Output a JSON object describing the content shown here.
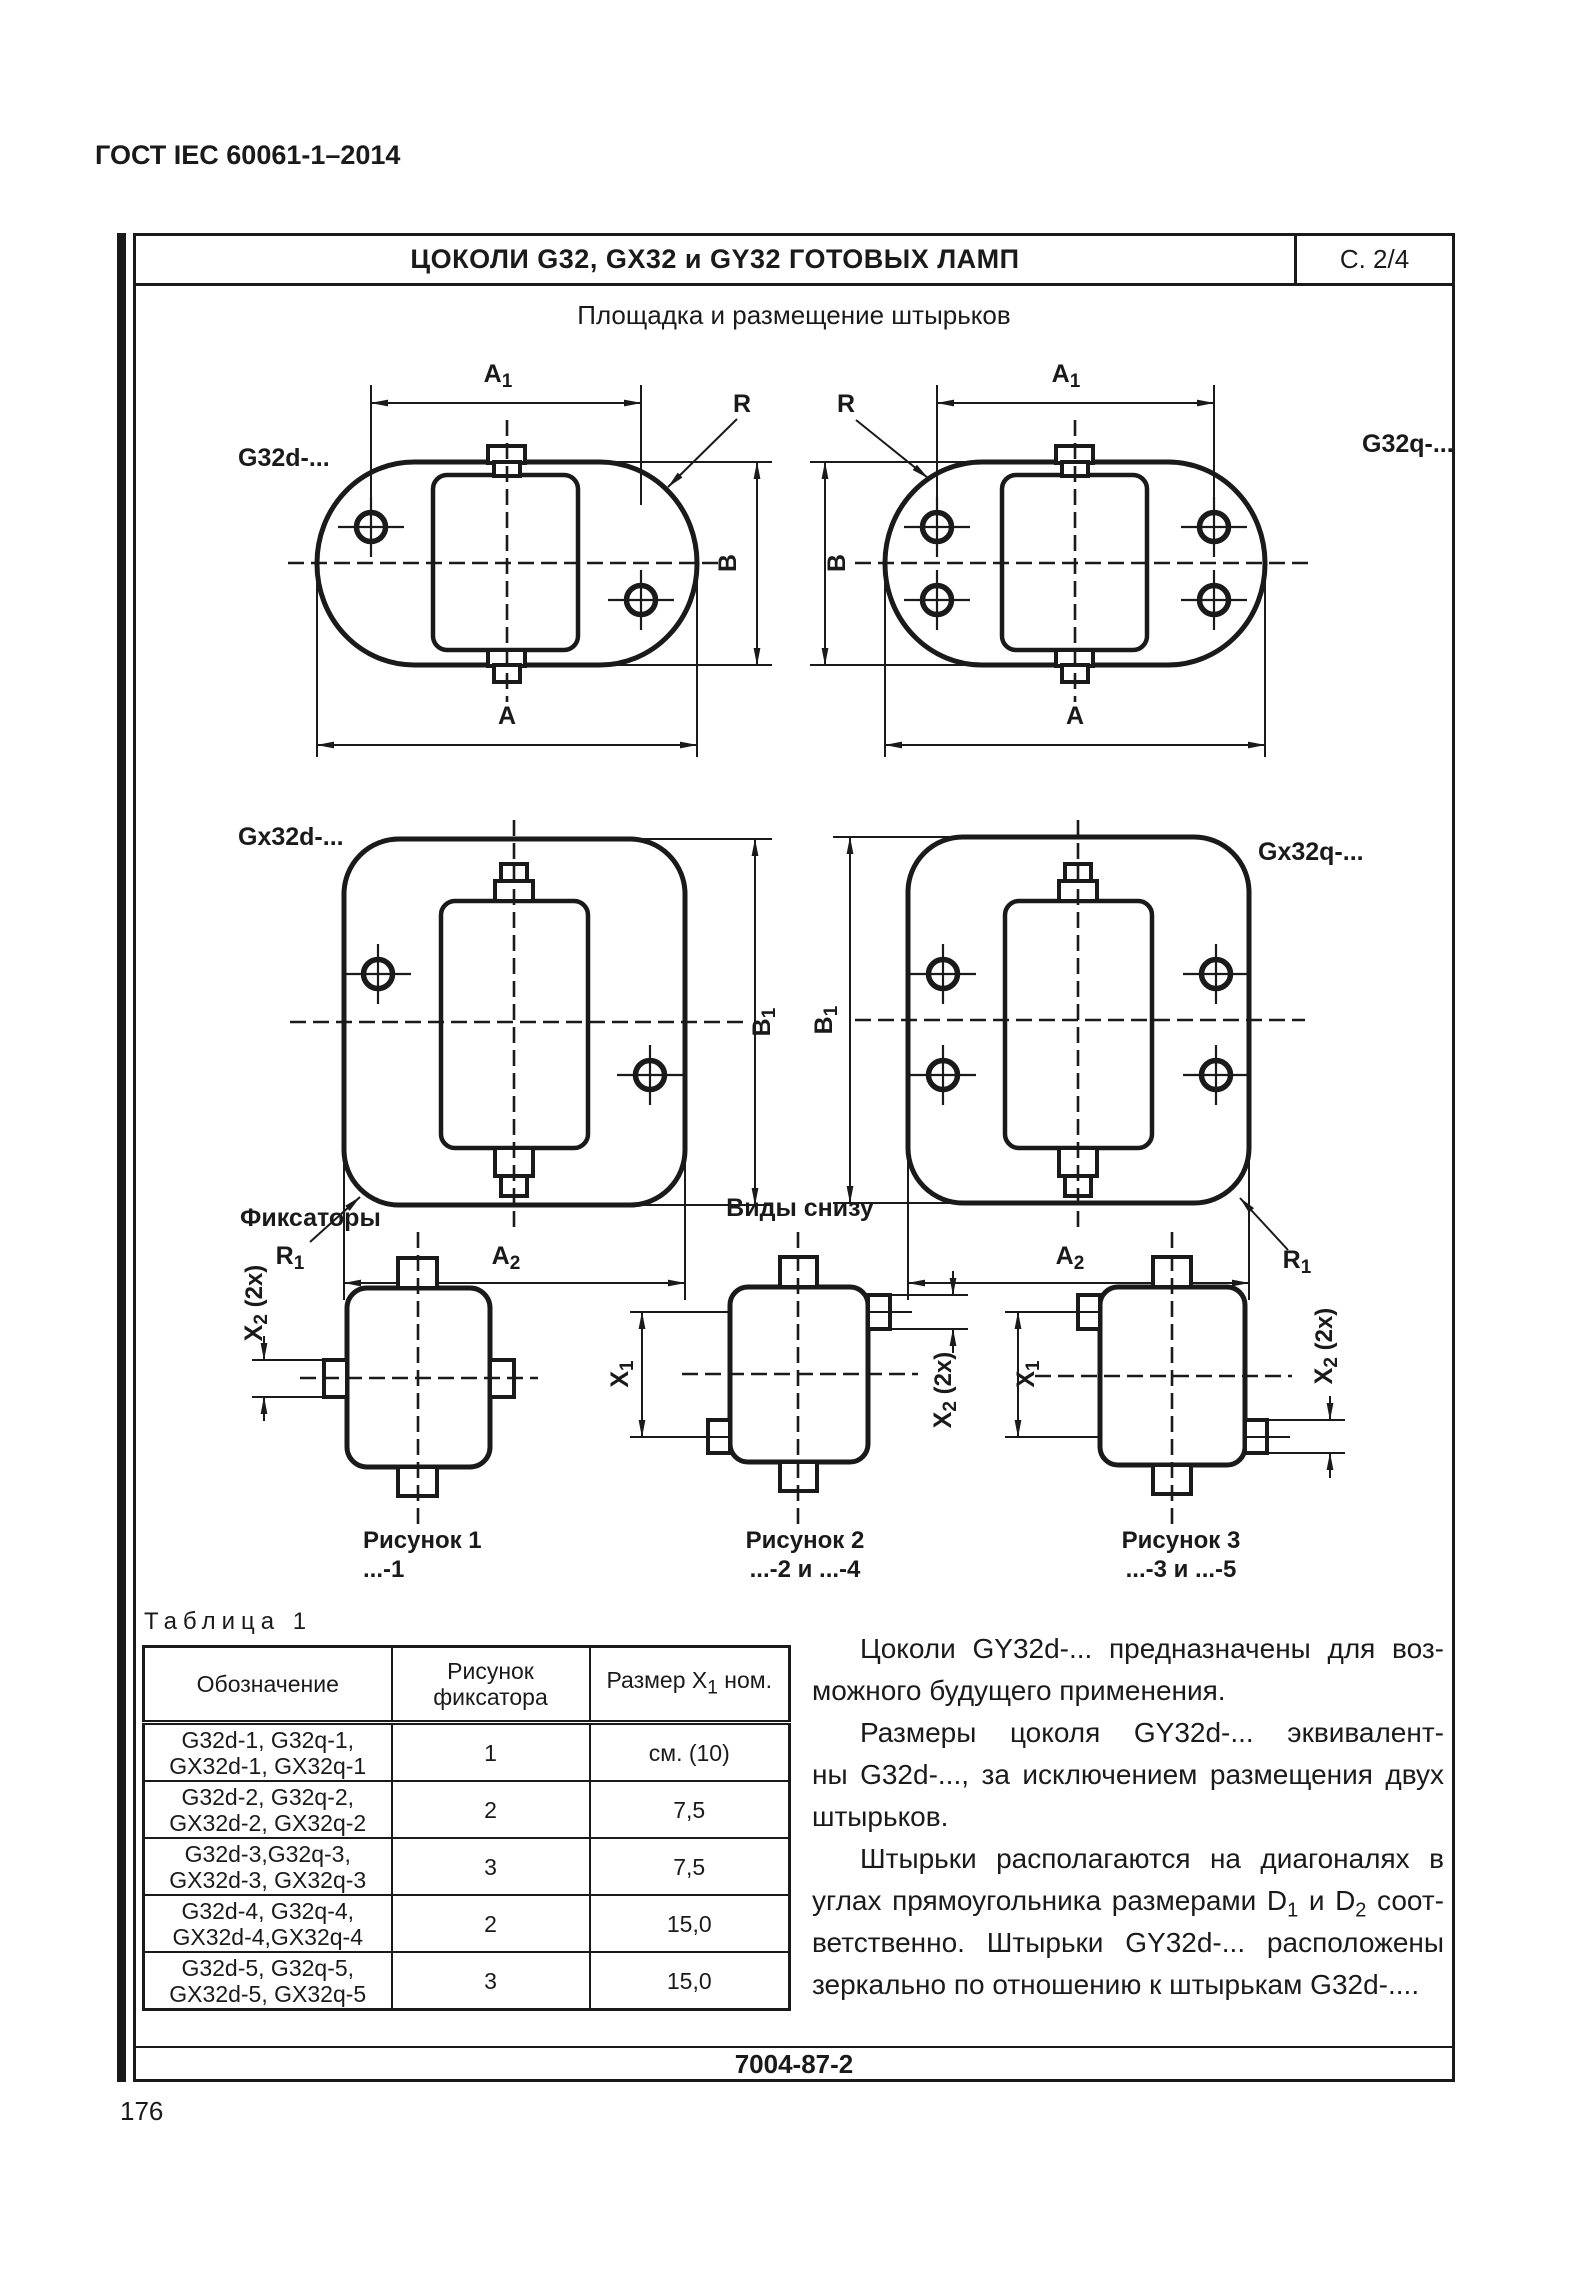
{
  "doc": {
    "standard": "ГОСТ IEC 60061-1–2014",
    "page_number": "176",
    "sheet_title": "ЦОКОЛИ G32, GX32 и GY32 ГОТОВЫХ ЛАМП",
    "sheet_ref": "С. 2/4",
    "subtitle": "Площадка и размещение штырьков",
    "footer_code": "7004-87-2"
  },
  "sections": {
    "fixators": "Фиксаторы",
    "bottom_views": "Виды снизу"
  },
  "drawings": {
    "g32d": "G32d-...",
    "g32q": "G32q-...",
    "gx32d": "Gx32d-...",
    "gx32q": "Gx32q-..."
  },
  "dims": {
    "A": "A",
    "A1b": "A",
    "A1s": "1",
    "A2b": "A",
    "A2s": "2",
    "B": "B",
    "B1b": "B",
    "B1s": "1",
    "R": "R",
    "R1b": "R",
    "R1s": "1",
    "X1b": "X",
    "X1s": "1",
    "X2b": "X",
    "X2s": "2",
    "X2suffix": " (2x)"
  },
  "figures": {
    "fig1": {
      "caption": "Рисунок 1",
      "variants": "...-1"
    },
    "fig2": {
      "caption": "Рисунок 2",
      "variants": "...-2 и ...-4"
    },
    "fig3": {
      "caption": "Рисунок 3",
      "variants": "...-3 и ...-5"
    }
  },
  "table": {
    "title": "Таблица 1",
    "col1_header": "Обозначение",
    "col2_header": "Рисунок фиксатора",
    "col3_header": {
      "pre": "Размер X",
      "sub": "1",
      "post": " ном."
    },
    "rows": [
      {
        "designations": "G32d-1, G32q-1,\nGX32d-1, GX32q-1",
        "figure": "1",
        "size": "см. (10)"
      },
      {
        "designations": "G32d-2, G32q-2,\nGX32d-2, GX32q-2",
        "figure": "2",
        "size": "7,5"
      },
      {
        "designations": "G32d-3,G32q-3,\nGX32d-3, GX32q-3",
        "figure": "3",
        "size": "7,5"
      },
      {
        "designations": "G32d-4, G32q-4,\nGX32d-4,GX32q-4",
        "figure": "2",
        "size": "15,0"
      },
      {
        "designations": "G32d-5, G32q-5,\nGX32d-5, GX32q-5",
        "figure": "3",
        "size": "15,0"
      }
    ]
  },
  "paragraphs": {
    "p1l1": "Цоколи GY32d-... предназначены для воз-",
    "p1l2": "можного будущего применения.",
    "p2l1": "Размеры цоколя GY32d-... эквивалент-",
    "p2l2": "ны G32d-..., за исключением размещения двух",
    "p2l3": "штырьков.",
    "p3l1": "Штырьки располагаются на диагоналях в",
    "p3l2a": "углах прямоугольника размерами D",
    "p3l2sub1": "1",
    "p3l2b": " и D",
    "p3l2sub2": "2",
    "p3l2c": " соот-",
    "p3l3": "ветственно. Штырьки GY32d-... расположены",
    "p3l4": "зеркально по отношению к штырькам G32d-...."
  }
}
